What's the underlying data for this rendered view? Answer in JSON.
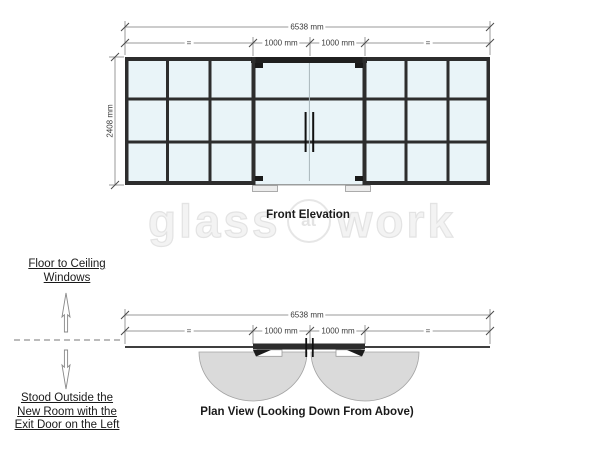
{
  "watermark": {
    "left": "glass",
    "mid": "at",
    "right": "work"
  },
  "elevation": {
    "title": "Front Elevation",
    "dim_total": "6538 mm",
    "dim_eq_left": "=",
    "dim_door_left": "1000 mm",
    "dim_door_right": "1000 mm",
    "dim_eq_right": "=",
    "dim_height": "2408 mm"
  },
  "plan": {
    "title": "Plan View (Looking Down From Above)",
    "dim_total": "6538 mm",
    "dim_eq_left": "=",
    "dim_door_left": "1000 mm",
    "dim_door_right": "1000 mm",
    "dim_eq_right": "="
  },
  "annotations": {
    "floor_to_ceiling": "Floor to Ceiling Windows",
    "stood_outside": "Stood Outside the New Room with the Exit Door on the Left"
  },
  "colors": {
    "glass": "#e9f4f8",
    "frame": "#2d2d2d",
    "swing_arc": "#dadada",
    "dimension_line": "#9a9a9a"
  }
}
